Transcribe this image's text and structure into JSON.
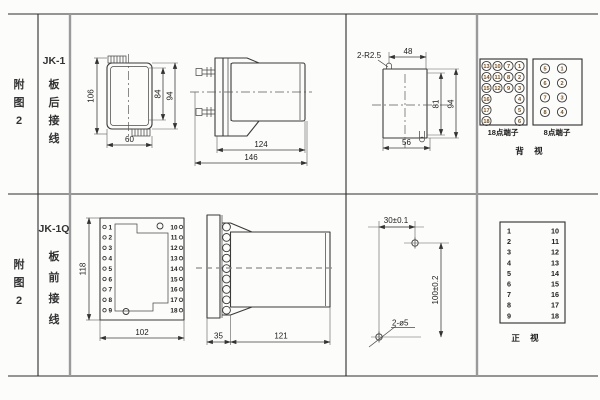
{
  "rows": [
    {
      "fig": "附图2",
      "model": "JK-1",
      "wiring": "板后接线"
    },
    {
      "fig": "附图2",
      "model": "JK-1Q",
      "wiring": "板前接线"
    }
  ],
  "dims": {
    "front_h": "106",
    "inner_h": "84",
    "outer_h": "94",
    "front_w": "60",
    "body_len": "124",
    "total_len": "146",
    "slot_r": "2-R2.5",
    "cut_top_w": "48",
    "cut_in_h": "81",
    "cut_out_h": "94",
    "cut_bot_w": "56",
    "q_h": "118",
    "q_w": "102",
    "q_plate": "35",
    "q_body": "121",
    "hole_dx": "30±0.1",
    "hole_dy": "100±0.2",
    "hole_d": "2-ø5"
  },
  "back_view": {
    "caption": "背 视",
    "t18": {
      "label": "18点端子",
      "grid": [
        [
          13,
          10,
          7,
          1
        ],
        [
          14,
          11,
          8,
          2
        ],
        [
          15,
          12,
          9,
          3
        ],
        [
          16,
          null,
          null,
          4
        ],
        [
          17,
          null,
          null,
          5
        ],
        [
          18,
          null,
          null,
          6
        ]
      ]
    },
    "t8": {
      "label": "8点端子",
      "grid": [
        [
          5,
          1
        ],
        [
          6,
          2
        ],
        [
          7,
          3
        ],
        [
          8,
          4
        ]
      ]
    }
  },
  "front_view": {
    "caption": "正 视",
    "left": [
      "1",
      "2",
      "3",
      "4",
      "5",
      "6",
      "7",
      "8",
      "9"
    ],
    "right": [
      "10",
      "11",
      "12",
      "13",
      "14",
      "15",
      "16",
      "17",
      "18"
    ]
  },
  "jk1q_terminals": {
    "left": [
      "1",
      "2",
      "3",
      "4",
      "5",
      "6",
      "7",
      "8",
      "9"
    ],
    "right": [
      "10",
      "11",
      "12",
      "13",
      "14",
      "15",
      "16",
      "17",
      "18"
    ]
  }
}
